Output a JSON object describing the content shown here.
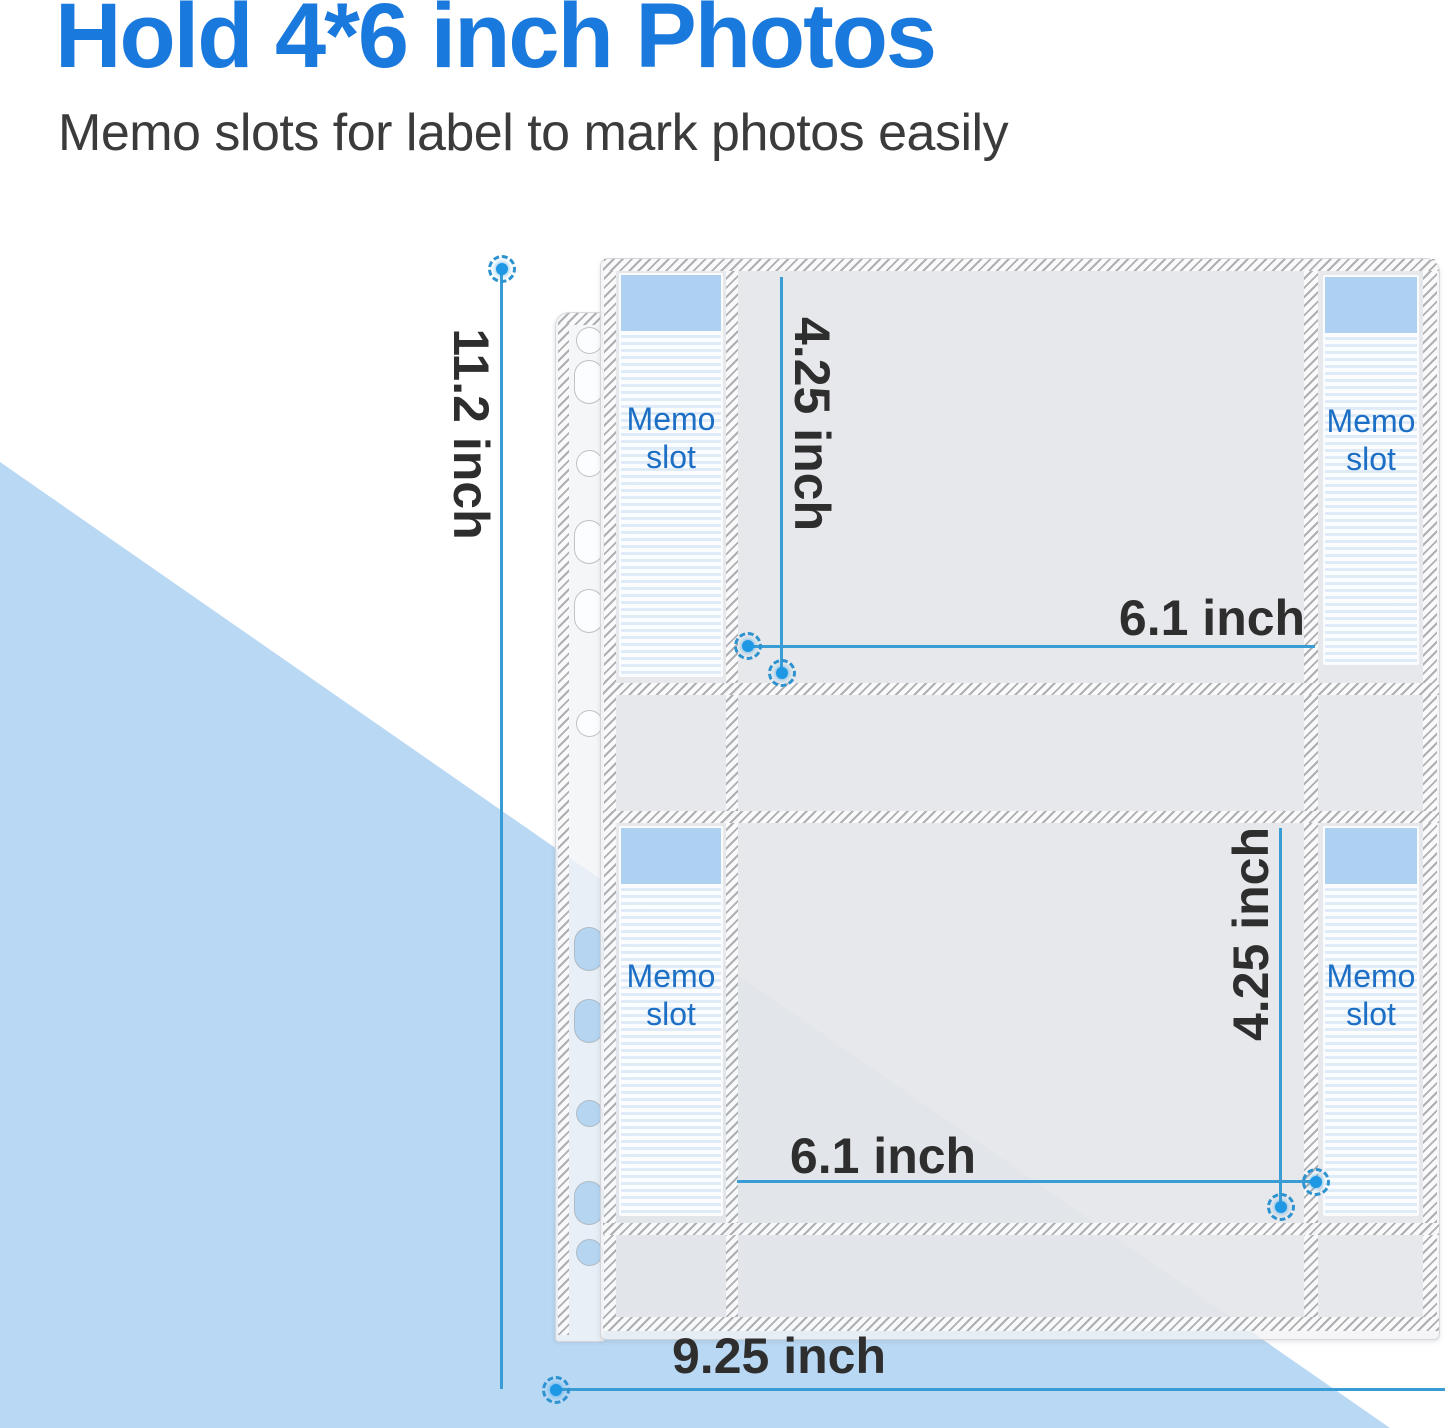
{
  "header": {
    "title": "Hold 4*6 inch Photos",
    "subtitle": "Memo slots for label to mark photos easily"
  },
  "sheet": {
    "binder_holes": 11,
    "memo_slots": [
      {
        "position": "top-left",
        "line1": "Memo",
        "line2": "slot"
      },
      {
        "position": "top-right",
        "line1": "Memo",
        "line2": "slot"
      },
      {
        "position": "bottom-left",
        "line1": "Memo",
        "line2": "slot"
      },
      {
        "position": "bottom-right",
        "line1": "Memo",
        "line2": "slot"
      }
    ]
  },
  "dimensions": {
    "sheet_height": "11.2 inch",
    "sheet_width": "9.25 inch",
    "top_pocket_height": "4.25 inch",
    "top_pocket_width": "6.1 inch",
    "bottom_pocket_height": "4.25 inch",
    "bottom_pocket_width": "6.1 inch"
  },
  "colors": {
    "title_blue": "#1a79dc",
    "subtitle_gray": "#3b3b3b",
    "background_triangle_blue": "#b9d8f4",
    "dimension_line_blue": "#3a9cd4",
    "dimension_text": "#2e2e2e",
    "memo_text_blue": "#1c6fc4",
    "memo_header_blue": "#accff0",
    "pocket_gray": "#e8e9ea"
  }
}
